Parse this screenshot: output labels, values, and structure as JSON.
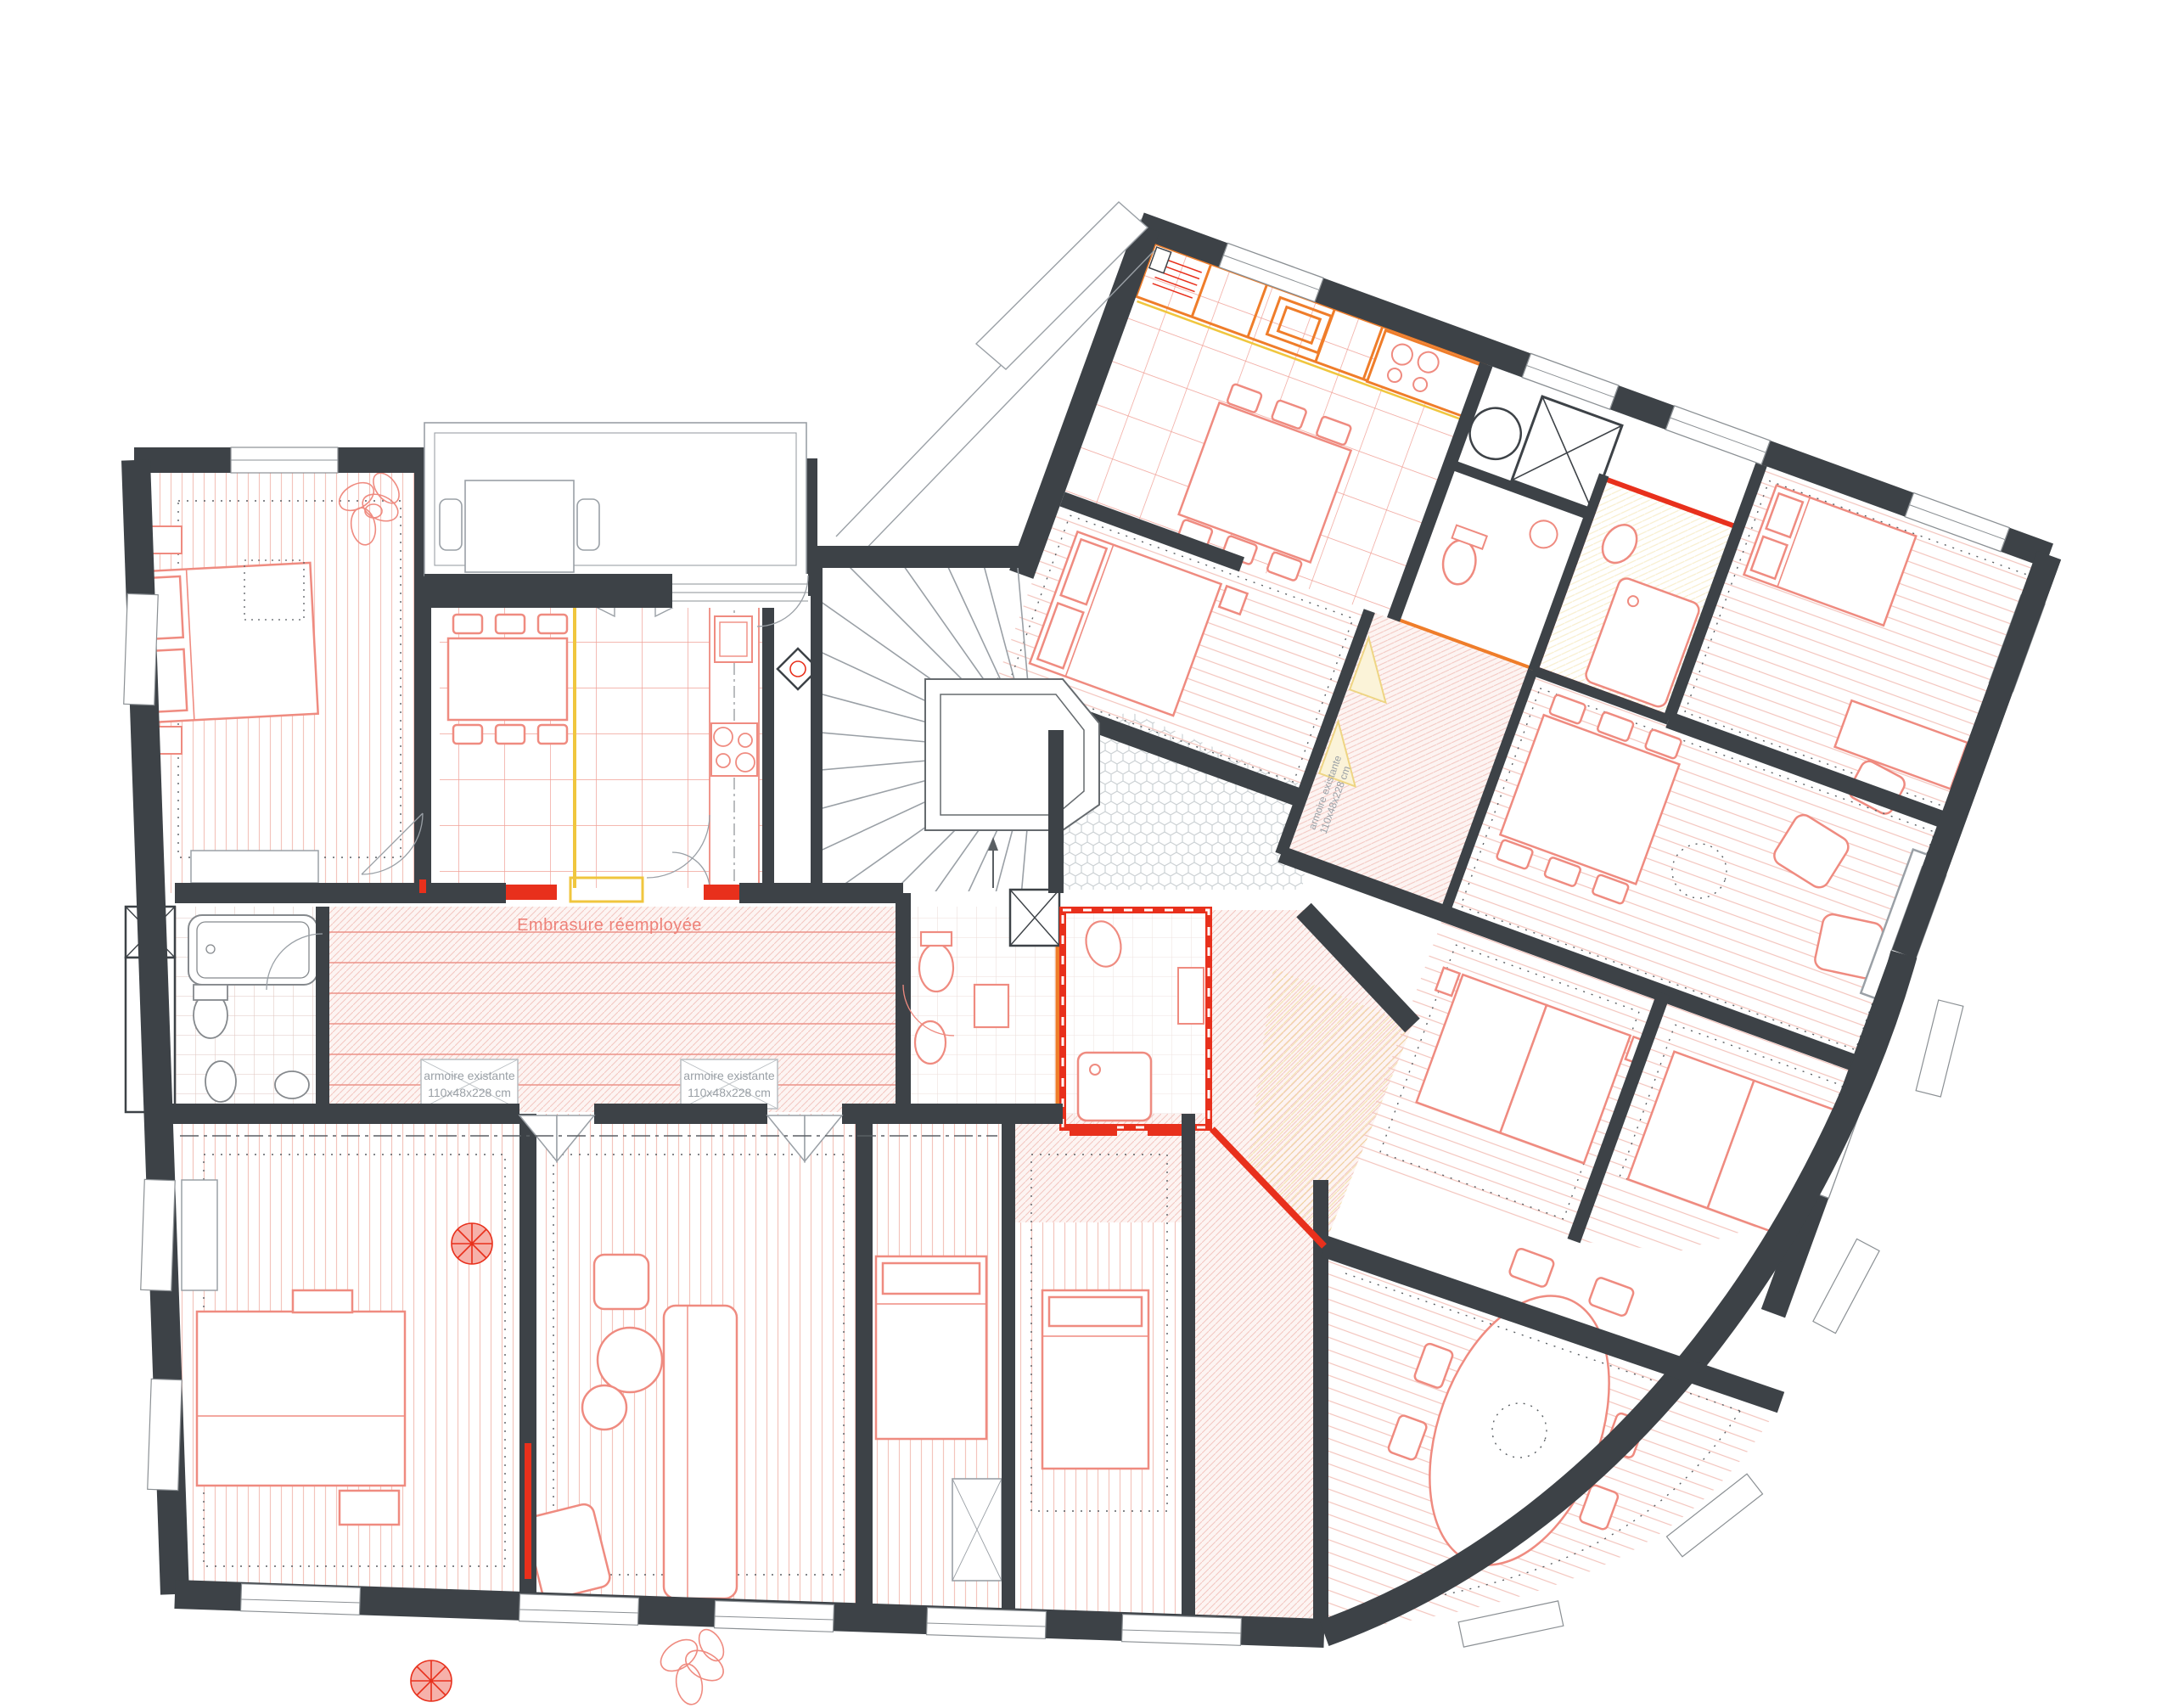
{
  "plan": {
    "type": "architectural-floor-plan",
    "annotations": {
      "embrasure": "Embrasure réemployée",
      "armoire": {
        "line1": "armoire existante",
        "line2": "110x48x228 cm"
      }
    },
    "colors": {
      "wall": "#3d4247",
      "new_partition_red": "#e8301c",
      "joinery_orange": "#ef7d2a",
      "demolition_yellow": "#f0c63e",
      "furniture_red": "#ef8b80",
      "furniture_gray": "#9aa0a6",
      "floor_stripe_pink": "#f3c4bd",
      "kitchen_grid_red": "#f0a096",
      "hatch_pink": "#f2c6c0",
      "corridor_line_red": "#ec9187",
      "honeycomb_gray": "#ccd1d4",
      "text_red": "#ee8279",
      "text_gray": "#9aa0a6"
    }
  }
}
